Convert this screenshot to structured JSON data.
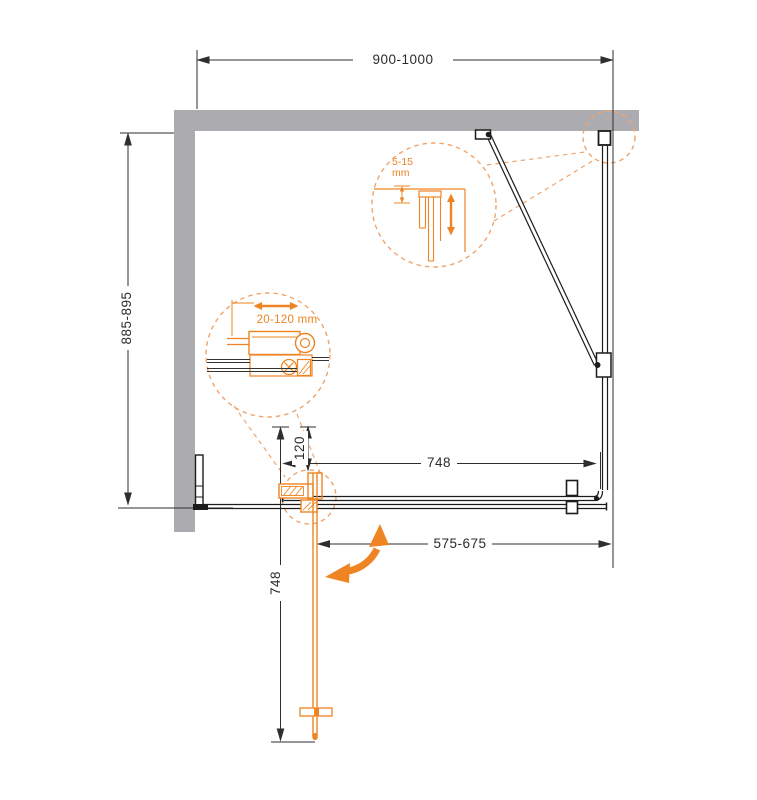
{
  "drawing_type": "shower-enclosure-installation-plan",
  "dimensions": {
    "top_width": "900-1000",
    "left_depth": "885-895",
    "door_width_closed": "748",
    "pivot_offset": "120",
    "opening_width": "575-675",
    "door_width_open": "748"
  },
  "details": {
    "profile_gap": {
      "label": "5-15\nmm"
    },
    "hinge_range": {
      "label": "20-120 mm"
    }
  },
  "colors": {
    "background": "#FFFFFF",
    "wall_gray": "#ACACB0",
    "drawing_line": "#1C1C1C",
    "dimension_line": "#2E2E2E",
    "accent_orange": "#EE8422",
    "dashed_orange": "#F0A46B"
  }
}
